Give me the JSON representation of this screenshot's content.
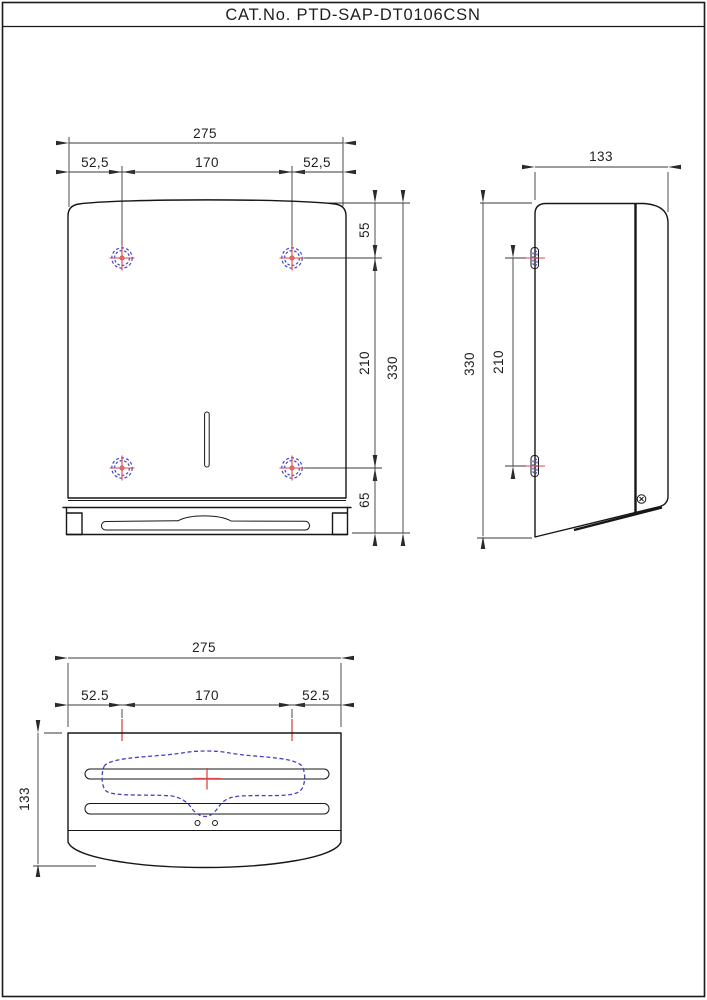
{
  "title_block": {
    "label": "CAT.No. PTD-SAP-DT0106CSN"
  },
  "colors": {
    "line": "#161616",
    "hidden_feature_blue": "#4343c8",
    "centerline_red": "#d84848",
    "background": "#ffffff"
  },
  "front_view": {
    "width_total": "275",
    "offset_left": "52,5",
    "hole_span": "170",
    "offset_right": "52,5",
    "top_to_hole": "55",
    "hole_to_hole": "210",
    "height_total": "330",
    "hole_to_bottom": "65"
  },
  "side_view": {
    "depth": "133",
    "height_total": "330",
    "hole_to_hole": "210"
  },
  "bottom_view": {
    "width_total": "275",
    "offset_left": "52.5",
    "hole_span": "170",
    "offset_right": "52.5",
    "depth": "133"
  }
}
